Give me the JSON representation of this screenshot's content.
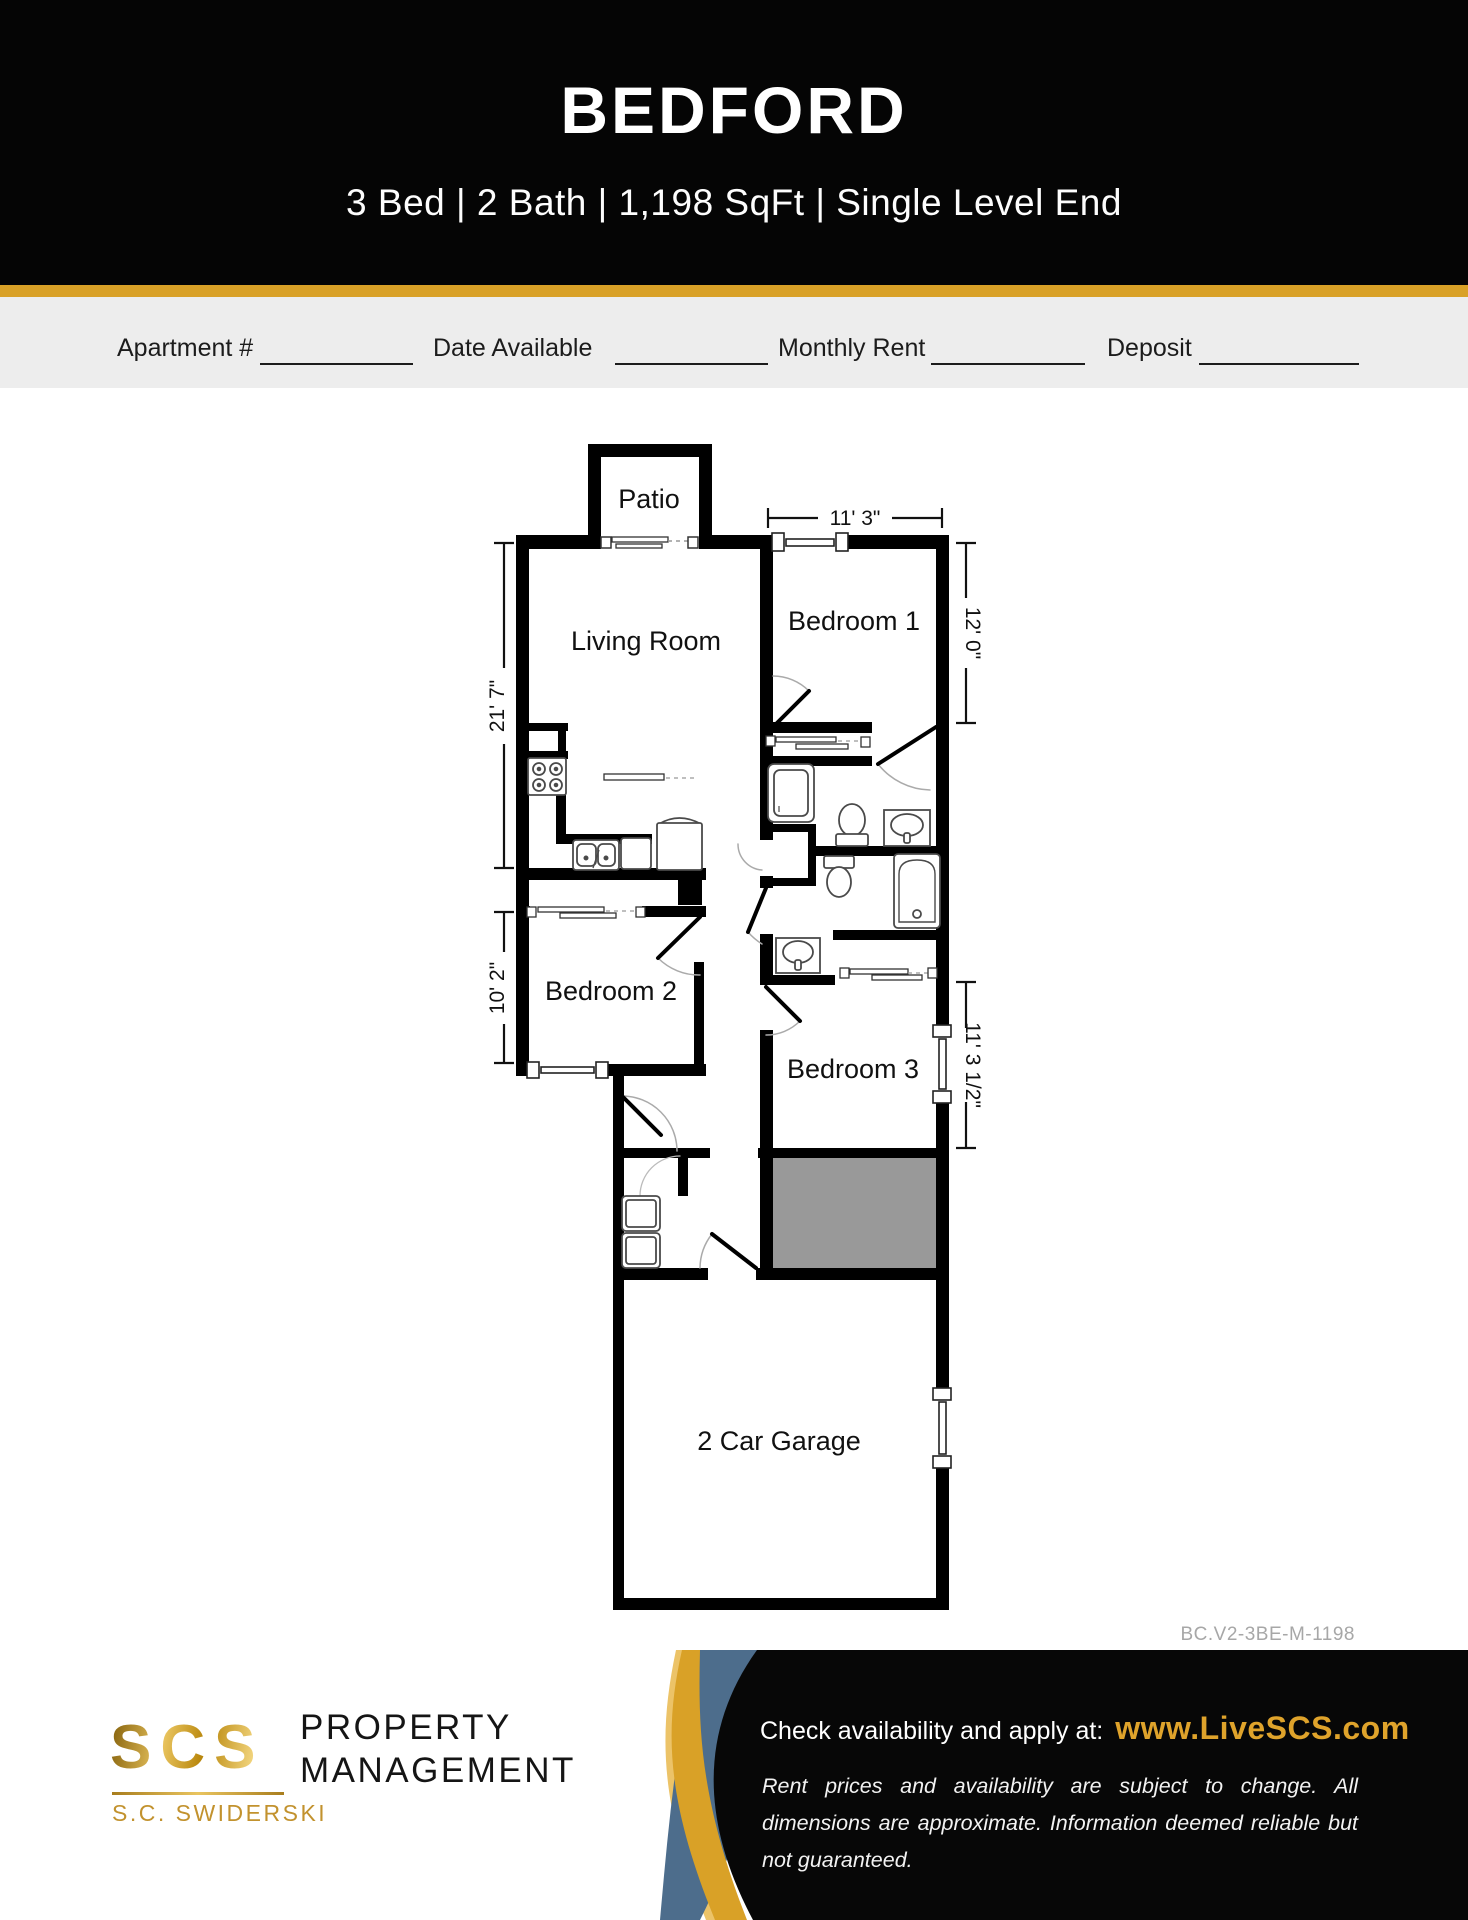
{
  "header": {
    "title": "BEDFORD",
    "subtitle": "3 Bed | 2 Bath | 1,198 SqFt | Single Level End"
  },
  "form_fields": {
    "apartment_label": "Apartment #",
    "date_label": "Date Available",
    "rent_label": "Monthly Rent",
    "deposit_label": "Deposit"
  },
  "floor_plan": {
    "rooms": {
      "patio": "Patio",
      "living": "Living Room",
      "bed1": "Bedroom 1",
      "bed2": "Bedroom 2",
      "bed3": "Bedroom 3",
      "garage": "2 Car Garage"
    },
    "dimensions": {
      "bed1_width": "11' 3\"",
      "bed1_height": "12' 0\"",
      "living_height": "21' 7\"",
      "bed2_height": "10' 2\"",
      "bed3_height": "11' 3 1/2\""
    }
  },
  "plan_code": "BC.V2-3BE-M-1198",
  "footer": {
    "logo_scs": "SCS",
    "logo_company": "S.C. SWIDERSKI",
    "brand_line1": "PROPERTY",
    "brand_line2": "MANAGEMENT",
    "cta": "Check availability and apply at:",
    "url": "www.LiveSCS.com",
    "disclaimer": "Rent prices and availability are subject to change. All dimensions are approximate. Information deemed reliable but not guaranteed."
  },
  "colors": {
    "accent_gold": "#D9A127",
    "wave_blue": "#4D6D8C",
    "utility_gray": "#999999"
  }
}
